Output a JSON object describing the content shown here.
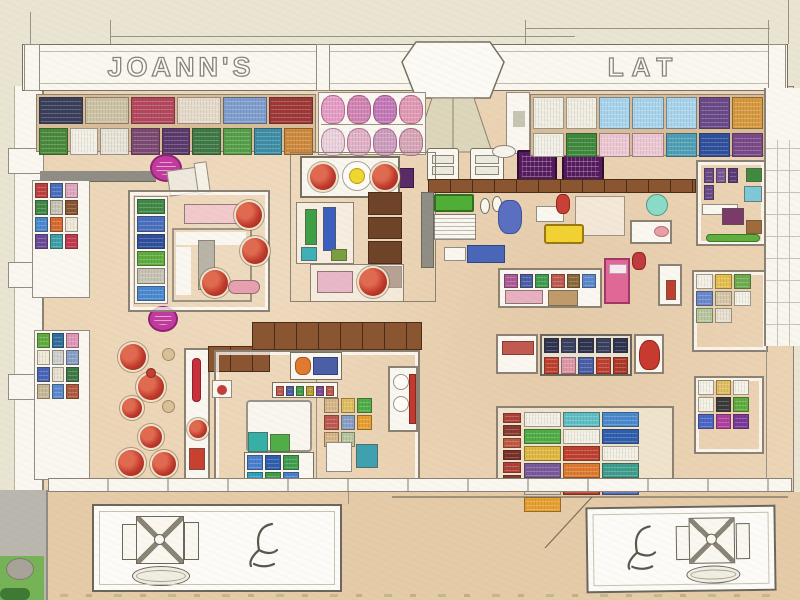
{
  "facade": {
    "left_sign": "JOANN'S",
    "right_sign": "LAT"
  },
  "palette": {
    "outer": "#e9e5d2",
    "floor": "#ecd5b6",
    "apron": "#e6cba8",
    "line": "#8b8274",
    "ink": "#6a665c",
    "white": "#f9f7f0",
    "shelfwood": "#d8bd98",
    "wood": "#8a5632",
    "woodDark": "#6e4328",
    "aisleGray": "#8f8d84",
    "magenta": "#c23a9e",
    "screenPurple": "#551a5e",
    "yellow": "#f2d232",
    "grass": "#76b356",
    "sidewalk": "#b9b7ae",
    "wreath": "#c0392b",
    "pink": "#e06898",
    "denim": "#4a66b8",
    "green": "#4fae35"
  },
  "shelves": {
    "top_left_row1": [
      "#3a3f5c",
      "#cfc3a6",
      "#b5485f",
      "#e7dccb",
      "#7f9fd0",
      "#a03838"
    ],
    "top_left_row2": [
      "#4a8a3c",
      "#f2efe6",
      "#e8e4d8",
      "#7c4a72",
      "#5c3a6e",
      "#3f7a46",
      "#57a04a",
      "#3e8fa8",
      "#d08a3e"
    ],
    "top_mid_row1": [
      "#e79ec6",
      "#d285b5",
      "#c47ab8",
      "#e39bb5"
    ],
    "top_mid_row2": [
      "#ecd3de",
      "#e2b3c8",
      "#cf9ec0",
      "#d8a8b8"
    ],
    "top_right_row1": [
      "#f0ede2",
      "#f0ede2",
      "#a9d5ee",
      "#a9d5ee",
      "#a9d5ee",
      "#6b4a8a",
      "#d89a40"
    ],
    "top_right_row2": [
      "#f2efe6",
      "#3f8a3f",
      "#eec9d4",
      "#eec9d4",
      "#4fa0b8",
      "#2f4f9f",
      "#7a4a8a"
    ],
    "left_wall_a": [
      "#c04040",
      "#4a6fc0",
      "#e0a8c0",
      "#3f8a46",
      "#c8c4b4",
      "#8a5632",
      "#4a8ad0",
      "#d86a30",
      "#f0e8d8",
      "#6a4a9a",
      "#3fa0a8",
      "#c03a50"
    ],
    "left_wall_b": [
      "#5fae3f",
      "#2f6f9f",
      "#e098b8",
      "#f0ead8",
      "#d0d0cc",
      "#8aa0c8",
      "#4a66b8",
      "#e8e0d0",
      "#3f7a46",
      "#c8b898",
      "#5a8ad0",
      "#b05a40"
    ],
    "room_bolts": [
      "#3f8a46",
      "#4a6fc0",
      "#2f4f9f",
      "#5fae3f",
      "#c8c4b4",
      "#4a8ad0"
    ],
    "roomA_purple": [
      "#6b4a8a",
      "#7a5a9a",
      "#5a3a7a",
      "#6b4a8a"
    ],
    "banner_row": [
      "#c05a50",
      "#4a5fa8",
      "#3f9f4f",
      "#c0a030",
      "#7a4a9a",
      "#c05a50"
    ],
    "case_row": [
      "#b05a9a",
      "#4a5fa8",
      "#3f9f4f",
      "#c05a50",
      "#8a6a3a",
      "#5a8ad0"
    ],
    "bottom_shelf": [
      "#4a7fd0",
      "#2f5fb0",
      "#3f9f4f",
      "#2fa0c0",
      "#3f9f4f",
      "#4a7fd0"
    ],
    "crate_scribbles": [
      "#d8b888",
      "#e0c060",
      "#4fae45",
      "#c05a50",
      "#8aa0c8",
      "#e8a030",
      "#d8b888",
      "#b8c8a0"
    ],
    "disp2_row1": [
      "#2e3350",
      "#3a4060",
      "#2e3350",
      "#3a4060",
      "#2e3350"
    ],
    "disp2_row2": [
      "#c04030",
      "#e098a8",
      "#4a5fa8",
      "#c04030",
      "#b03828"
    ],
    "merch_left_col": [
      "#b04038",
      "#8a3a30",
      "#c05a40",
      "#7a2f28",
      "#b04038",
      "#8a3a30"
    ],
    "merch_grid": [
      "#f2efe4",
      "#60c0c8",
      "#4a8ad0",
      "#4fae45",
      "#f2efe4",
      "#2f5fb0",
      "#e0b840",
      "#c04030",
      "#f2efe4",
      "#7a5a9a",
      "#e07a30",
      "#3f9f8f",
      "#d8d4c4",
      "#b03828",
      "#4a66b8",
      "#e8a030"
    ],
    "roomB_items": [
      "#f4f1e6",
      "#e8c050",
      "#6fae4f",
      "#6a8ad0",
      "#d8c8a8",
      "#f4f1e6",
      "#b8c8a0",
      "#e8e0d0"
    ],
    "roomC_items": [
      "#f4f1e6",
      "#e0c060",
      "#f4f1e6",
      "#f4f1e6",
      "#3a3a3a",
      "#5fae3f",
      "#4a66c8",
      "#b040a0",
      "#7a3a9a"
    ]
  }
}
